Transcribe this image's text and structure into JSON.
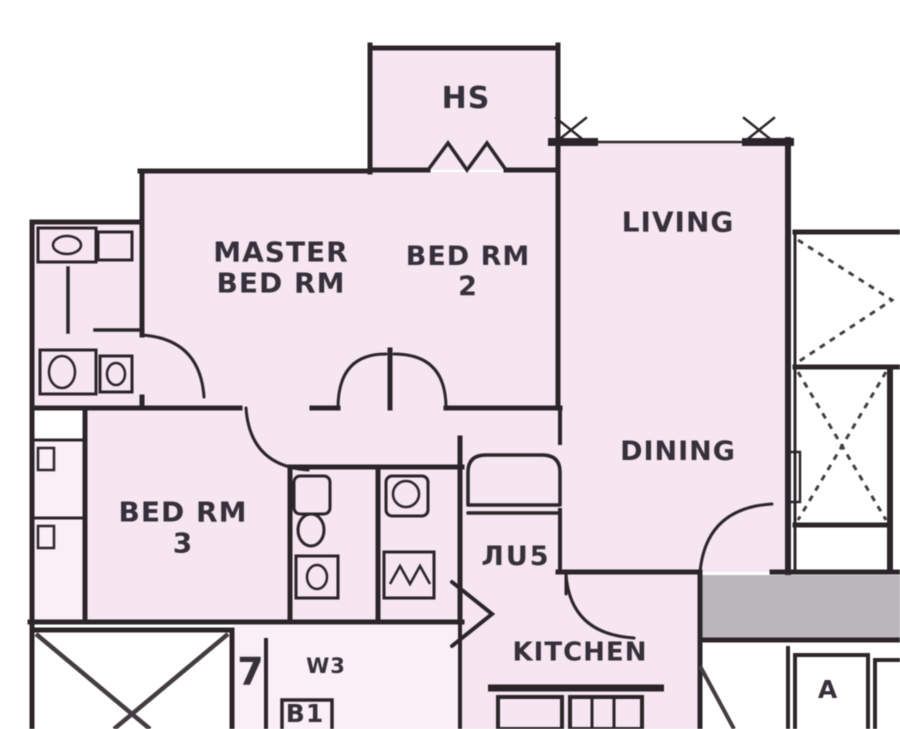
{
  "colors": {
    "paper": "#ffffff",
    "wall": "#2d272b",
    "dash": "#453f43",
    "room_fill": "#f2e3ee",
    "room_fill_light": "#f6ecf3",
    "corridor_fill": "#b8b4b7",
    "label_text": "#38323c"
  },
  "rooms": {
    "household_shelter": {
      "label": "HS"
    },
    "master_bedroom": {
      "line1": "MASTER",
      "line2": "BED RM"
    },
    "bedroom_2": {
      "line1": "BED RM",
      "line2": "2"
    },
    "living": {
      "label": "LIVING"
    },
    "dining": {
      "label": "DINING"
    },
    "bedroom_3": {
      "line1": "BED RM",
      "line2": "3"
    },
    "kitchen": {
      "label": "KITCHEN"
    }
  },
  "markers": {
    "window_schedule": "W3",
    "bath_schedule": "B1",
    "door_schedule": "7",
    "shaft_label": "A",
    "utility_label": "ЛU5"
  }
}
